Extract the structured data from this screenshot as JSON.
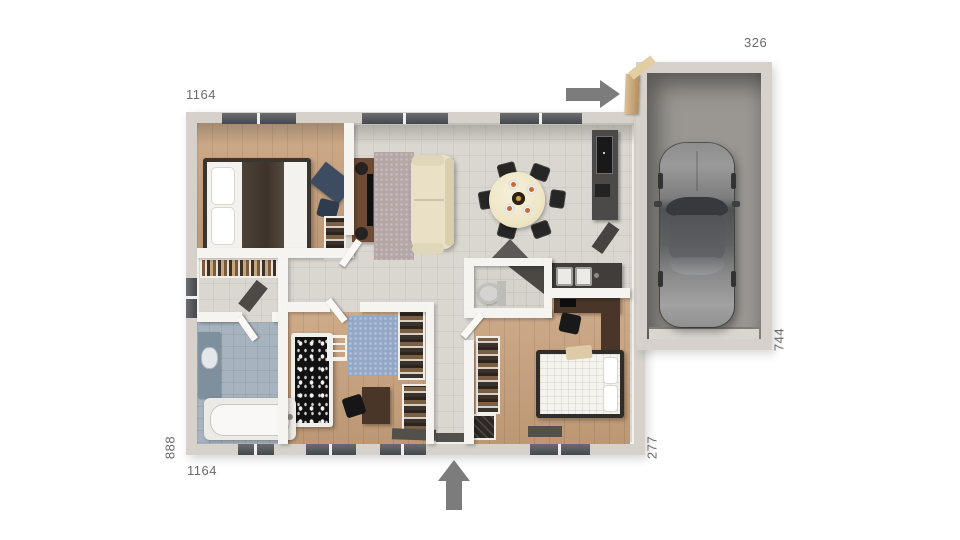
{
  "floorplan": {
    "dimensions": {
      "house_top": "1164",
      "house_bottom": "1164",
      "house_left": "888",
      "house_right": "277",
      "garage_top": "326",
      "garage_right": "744"
    },
    "icons": {
      "entry_arrow_top": "arrow-right",
      "entry_arrow_bottom": "arrow-up"
    },
    "colors": {
      "background": "#ffffff",
      "wall": "#d6d2cb",
      "wall_inner": "#f6f4f0",
      "tile_floor": "#dad7d1",
      "wood_floor": "#c8a17c",
      "bathroom_floor": "#a7b4c0",
      "garage_floor": "#9a9792",
      "arrow": "#7c7c7c",
      "label_text": "#6a6a6a"
    }
  }
}
